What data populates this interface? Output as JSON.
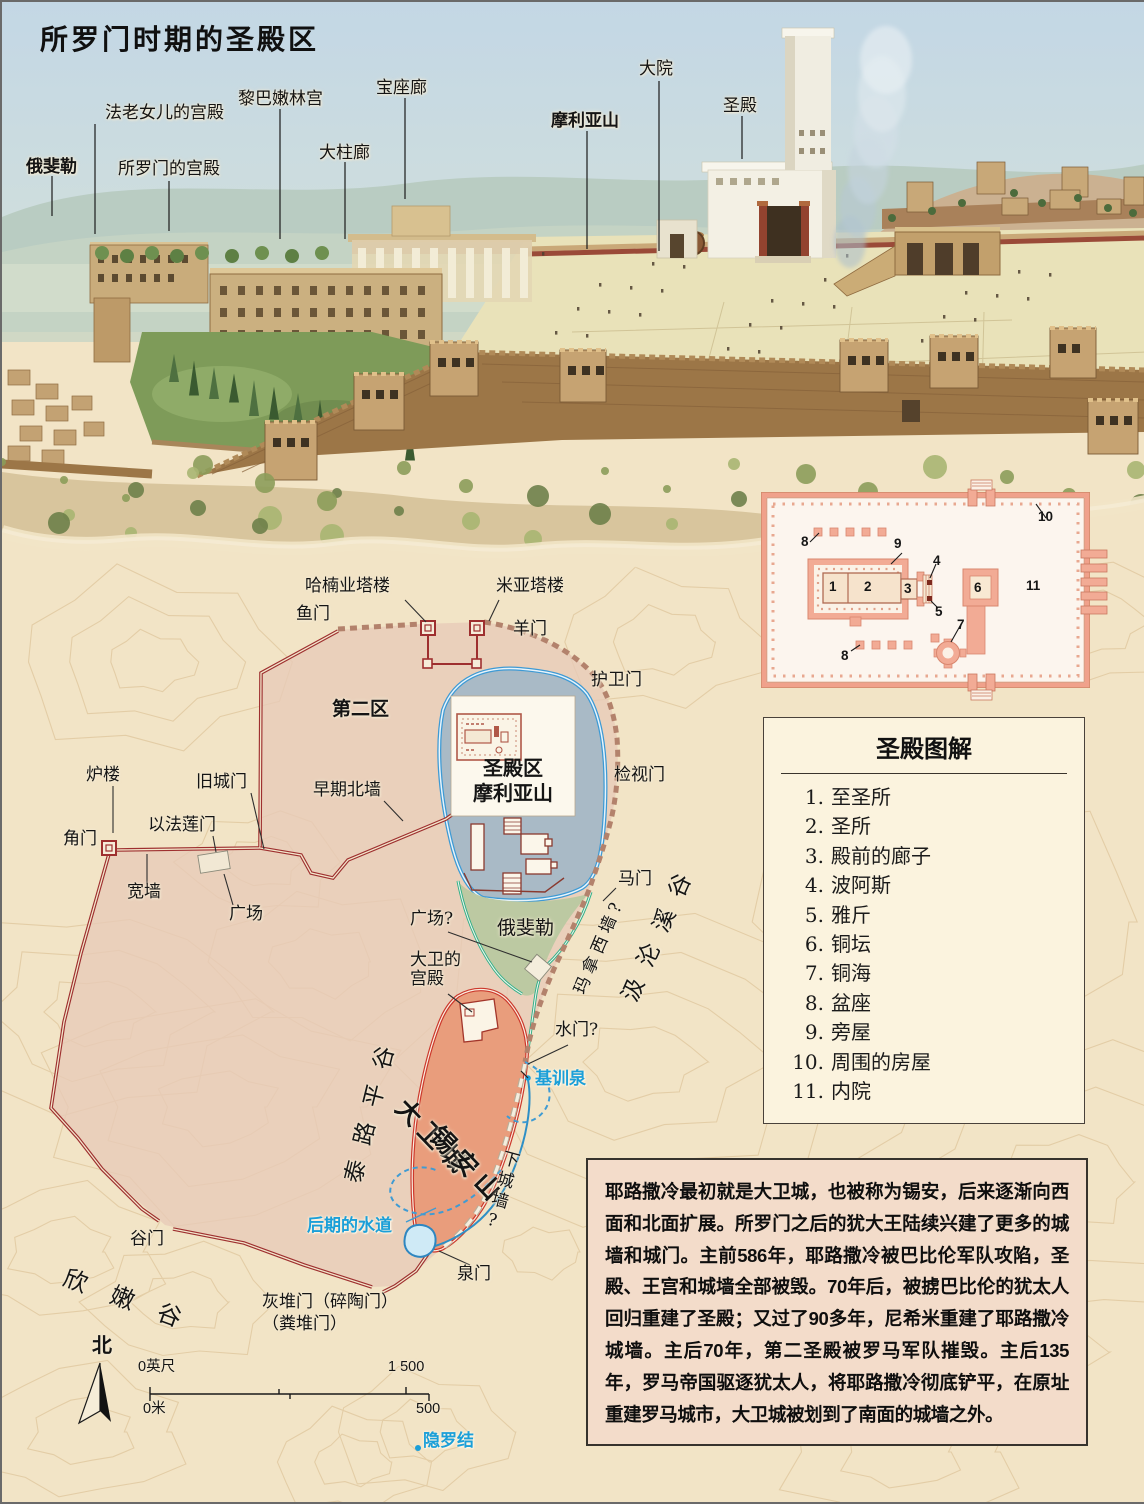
{
  "page": {
    "title": "所罗门时期的圣殿区"
  },
  "illustration": {
    "labels": {
      "pharaohs_daughter_palace": "法老女儿的宫殿",
      "ophel": "俄斐勒",
      "solomons_palace": "所罗门的宫殿",
      "house_of_forest_of_lebanon": "黎巴嫩林宫",
      "great_colonnade": "大柱廊",
      "throne_hall": "宝座廊",
      "mount_moriah": "摩利亚山",
      "great_court": "大院",
      "temple": "圣殿"
    }
  },
  "temple_plan": {
    "numbers": {
      "n1": "1",
      "n2": "2",
      "n3": "3",
      "n4": "4",
      "n5": "5",
      "n6": "6",
      "n7": "7",
      "n8a": "8",
      "n8b": "8",
      "n9": "9",
      "n10": "10",
      "n11": "11"
    }
  },
  "legend": {
    "title": "圣殿图解",
    "items": [
      {
        "num": "1.",
        "label": "至圣所"
      },
      {
        "num": "2.",
        "label": "圣所"
      },
      {
        "num": "3.",
        "label": "殿前的廊子"
      },
      {
        "num": "4.",
        "label": "波阿斯"
      },
      {
        "num": "5.",
        "label": "雅斤"
      },
      {
        "num": "6.",
        "label": "铜坛"
      },
      {
        "num": "7.",
        "label": "铜海"
      },
      {
        "num": "8.",
        "label": "盆座"
      },
      {
        "num": "9.",
        "label": "旁屋"
      },
      {
        "num": "10.",
        "label": "周围的房屋"
      },
      {
        "num": "11.",
        "label": "内院"
      }
    ]
  },
  "map": {
    "labels": {
      "fish_gate": "鱼门",
      "tower_of_hananel": "哈楠业塔楼",
      "tower_of_meah": "米亚塔楼",
      "sheep_gate": "羊门",
      "guard_gate": "护卫门",
      "second_district": "第二区",
      "inspection_gate": "检视门",
      "furnace_tower": "炉楼",
      "old_city_gate": "旧城门",
      "early_north_wall": "早期北墙",
      "ephraim_gate": "以法莲门",
      "corner_gate": "角门",
      "broad_wall": "宽墙",
      "plaza": "广场",
      "temple_area_title": "圣殿区",
      "temple_area_subtitle": "摩利亚山",
      "horse_gate": "马门",
      "manasseh_wall": "玛拿西墙?",
      "kidron_valley": "汲沦溪谷",
      "plaza_q": "广场?",
      "ophel": "俄斐勒",
      "davids_palace_l1": "大卫的",
      "davids_palace_l2": "宫殿",
      "water_gate": "水门?",
      "gihon_spring": "基训泉",
      "city_of_david": "大卫城",
      "mount_zion": "锡安山",
      "tyropoeon_valley": "泰路平谷",
      "lower_wall": "下城墙?",
      "later_aqueduct": "后期的水道",
      "spring_gate": "泉门",
      "valley_gate": "谷门",
      "hinnom_valley": "欣嫩谷",
      "ash_gate": "灰堆门（碎陶门）",
      "dung_gate": "（粪堆门）",
      "en_rogel": "隐罗结"
    }
  },
  "compass": {
    "north": "北"
  },
  "scale_bar": {
    "feet_start": "0英尺",
    "feet_end": "1 500",
    "meters_start": "0米",
    "meters_end": "500"
  },
  "history": {
    "text": "耶路撒冷最初就是大卫城，也被称为锡安，后来逐渐向西面和北面扩展。所罗门之后的犹大王陆续兴建了更多的城墙和城门。主前586年，耶路撒冷被巴比伦军队攻陷，圣殿、王宫和城墙全部被毁。70年后，被掳巴比伦的犹太人回归重建了圣殿；又过了90多年，尼希米重建了耶路撒冷城墙。主后70年，第二圣殿被罗马军队摧毁。主后135年，罗马帝国驱逐犹太人，将耶路撒冷彻底铲平，在原址重建罗马城市，大卫城被划到了南面的城墙之外。"
  },
  "colors": {
    "wall_red": "#9E2F2F",
    "later_wall": "#B3826C",
    "water_blue": "#2E8FC6",
    "cyan_label": "#1B9FD8",
    "mount_fill": "#A9BAC6",
    "ophel_green": "#BCC9A2",
    "city_fill": "#E7CEBB",
    "david_fill": "#E99D7C",
    "parchment": "#F2E4C6",
    "plan_salmon": "#F2AB95"
  }
}
